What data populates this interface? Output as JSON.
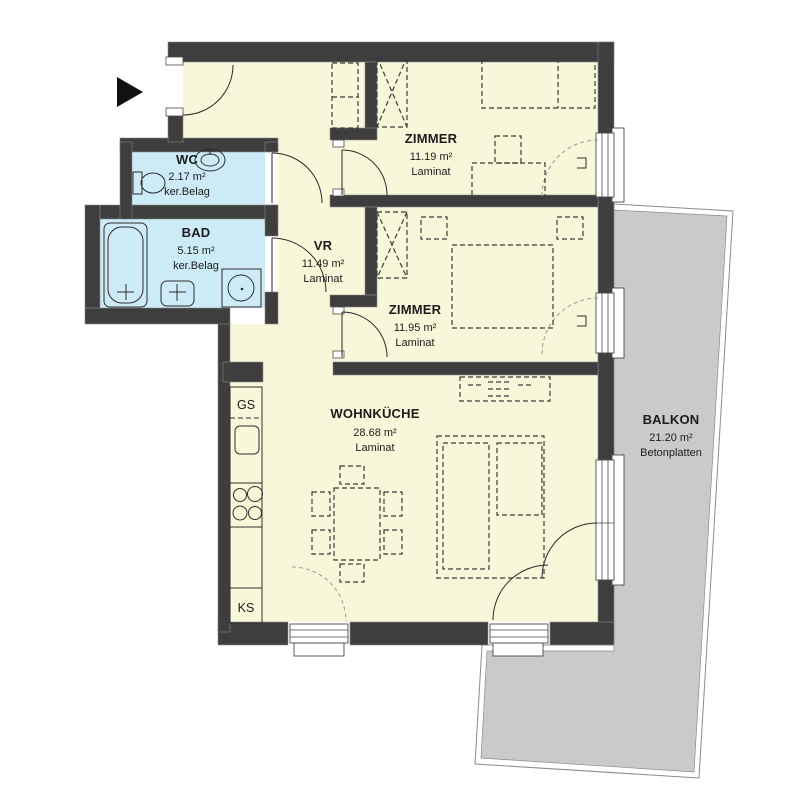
{
  "plan_title": "apartment-floor-plan",
  "rooms": {
    "wc": {
      "name": "WC",
      "area": "2.17 m²",
      "floor": "ker.Belag"
    },
    "bad": {
      "name": "BAD",
      "area": "5.15 m²",
      "floor": "ker.Belag"
    },
    "vr": {
      "name": "VR",
      "area": "11.49 m²",
      "floor": "Laminat"
    },
    "zimmer1": {
      "name": "ZIMMER",
      "area": "11.19 m²",
      "floor": "Laminat"
    },
    "zimmer2": {
      "name": "ZIMMER",
      "area": "11.95 m²",
      "floor": "Laminat"
    },
    "wohnkueche": {
      "name": "WOHNKÜCHE",
      "area": "28.68 m²",
      "floor": "Laminat"
    },
    "balkon": {
      "name": "BALKON",
      "area": "21.20 m²",
      "floor": "Betonplatten"
    }
  },
  "kitchen": {
    "gs": "GS",
    "ks": "KS"
  },
  "colors": {
    "wall": "#3e3e3e",
    "room_fill": "#f9f7da",
    "wet_room_fill": "#cdeaf7",
    "balcony_fill": "#cacaca",
    "background": "#ffffff"
  }
}
